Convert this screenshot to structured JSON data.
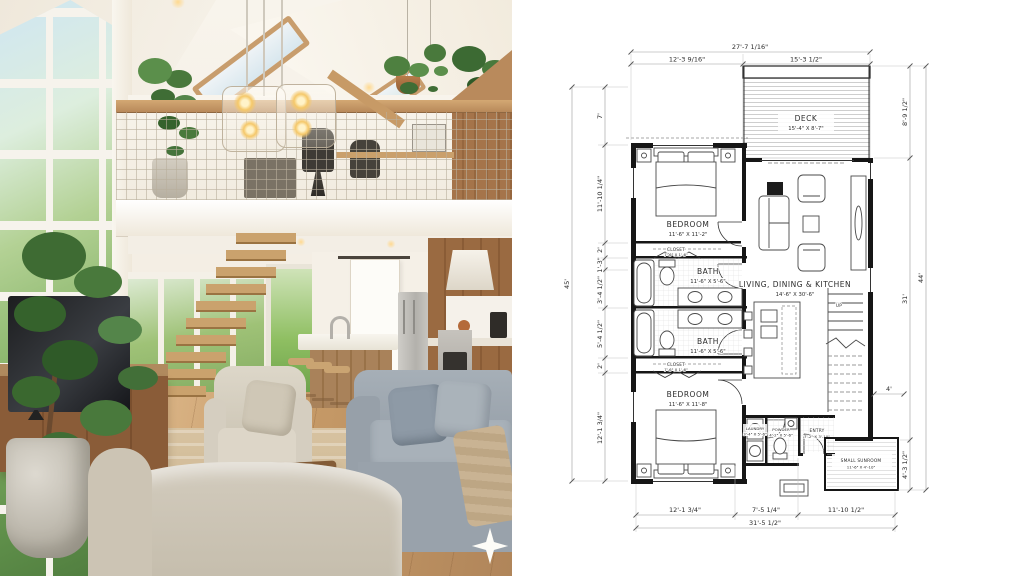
{
  "photo": {
    "description": "interior render of living room with loft",
    "watermark_icon": "four-point-sparkle"
  },
  "plan": {
    "dims": {
      "top": {
        "overall": "27'-7 1/16\"",
        "segments": [
          "12'-3 9/16\"",
          "15'-3 1/2\""
        ]
      },
      "left": {
        "overall": "45'",
        "segments": [
          "7'",
          "11'-10 1/4\"",
          "2'",
          "1'-3\"",
          "3'-4 1/2\"",
          "5'-4 1/2\"",
          "2'",
          "12'-1 3/4\""
        ]
      },
      "right": {
        "overall": "44'",
        "segments": [
          "8'-9 1/2\"",
          "31'",
          "4'-3 1/2\""
        ],
        "stair": "4'"
      },
      "bottom": {
        "overall": "31'-5 1/2\"",
        "segments": [
          "12'-1 3/4\"",
          "7'-5 1/4\"",
          "11'-10 1/2\""
        ]
      }
    },
    "rooms": {
      "deck": {
        "name": "DECK",
        "size": "15'-4\" X 8'-7\""
      },
      "bedroom1": {
        "name": "BEDROOM",
        "size": "11'-6\" X 11'-2\""
      },
      "closet1": {
        "name": "CLOSET",
        "size": "7'-6\" X 1'-6\""
      },
      "bath1": {
        "name": "BATH",
        "size": "11'-6\" X 5'-6\""
      },
      "bath2": {
        "name": "BATH",
        "size": "11'-6\" X 5'-6\""
      },
      "closet2": {
        "name": "CLOSET",
        "size": "7'-6\" X 1'-6\""
      },
      "bedroom2": {
        "name": "BEDROOM",
        "size": "11'-6\" X 11'-8\""
      },
      "living": {
        "name": "LIVING, DINING & KITCHEN",
        "size": "14'-6\" X 30'-6\""
      },
      "laundry": {
        "name": "LAUNDRY",
        "size": "3'-4\" X 5'-6\""
      },
      "powder": {
        "name": "POWDER",
        "size": "4'-2\" X 5'-6\""
      },
      "entry": {
        "name": "ENTRY",
        "size": "7'-2\" X 3'-10\""
      },
      "sunroom": {
        "name": "SMALL SUNROOM",
        "size": "11'-6\" X 4'-10\""
      },
      "stairs": {
        "label": "UP"
      }
    },
    "colors": {
      "wall": "#161616",
      "dimline": "#9a9a9a",
      "paper": "#ffffff"
    }
  }
}
